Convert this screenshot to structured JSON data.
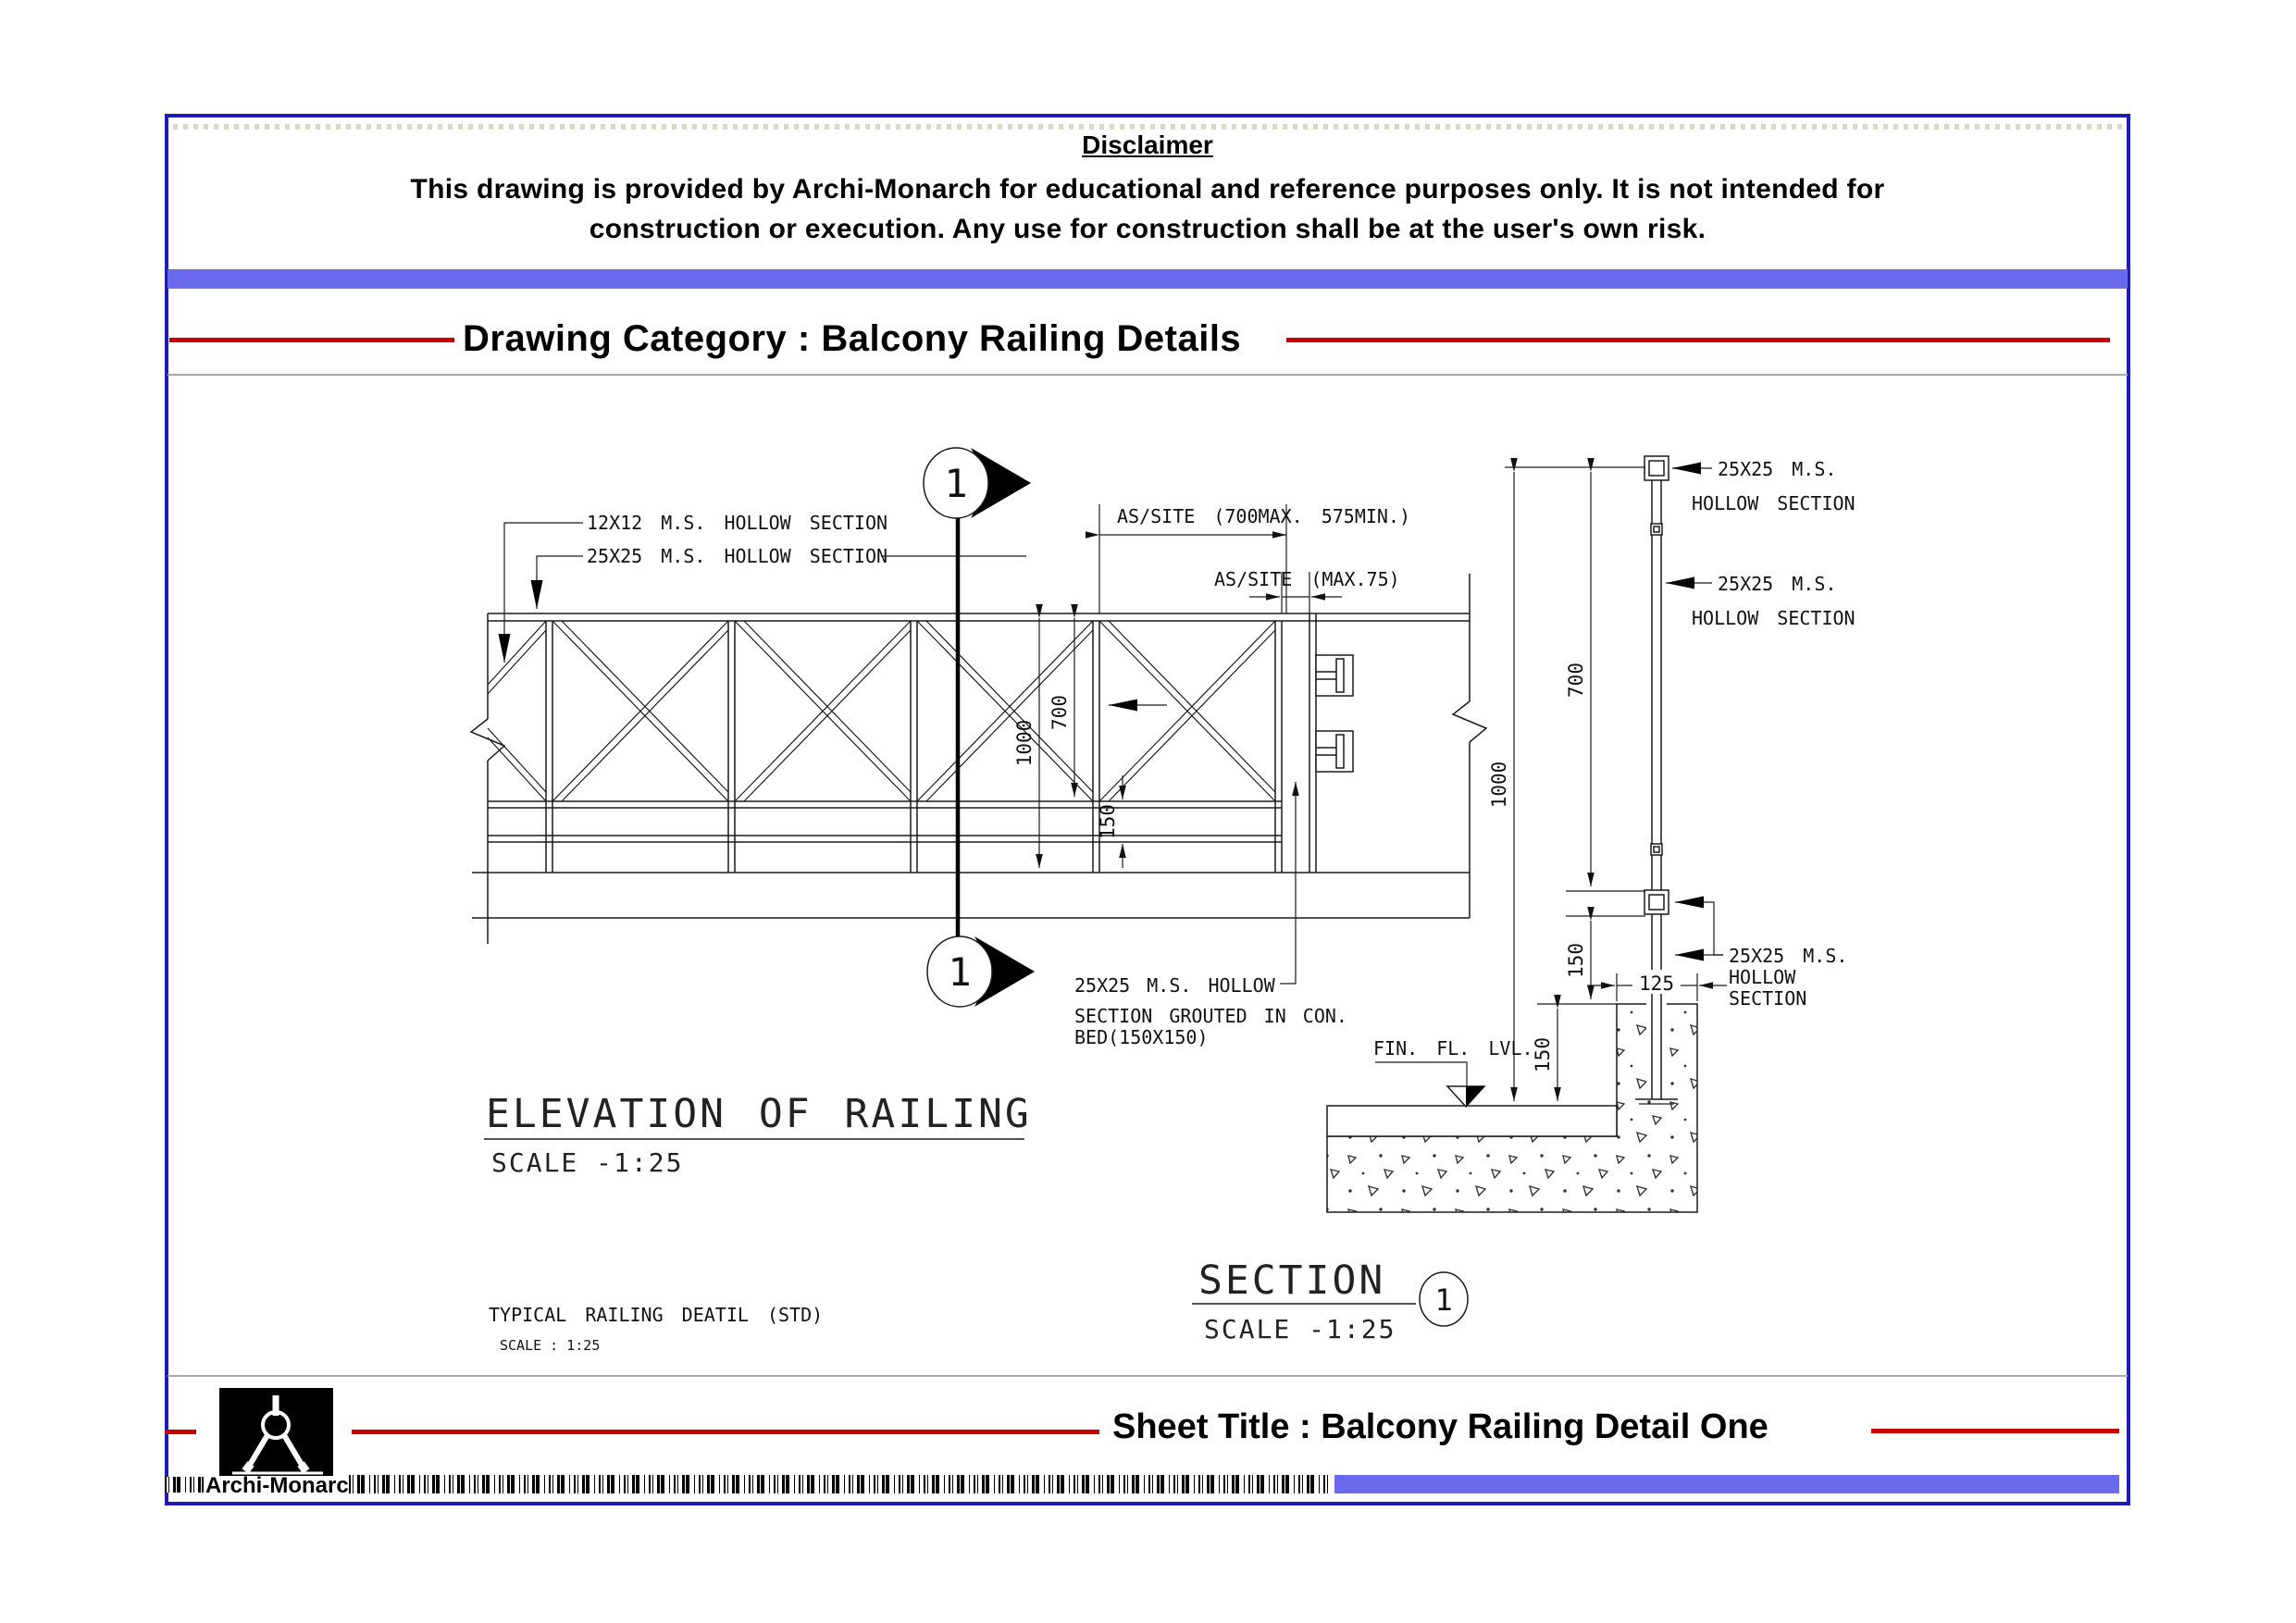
{
  "colors": {
    "border_navy": "#1d1ab5",
    "bar_blue": "#6a6aec",
    "accent_red": "#c80000",
    "line_black": "#1a1a1a"
  },
  "header": {
    "disclaimer_title": "Disclaimer",
    "disclaimer_line1": "This drawing is provided by Archi-Monarch for educational and reference purposes only. It is not intended for",
    "disclaimer_line2": "construction or execution. Any use for construction shall be at the user's own risk.",
    "category_label": "Drawing Category : Balcony Railing Details"
  },
  "footer": {
    "sheet_title": "Sheet Title : Balcony Railing Detail One",
    "brand": "Archi-Monarch"
  },
  "elevation": {
    "title": "ELEVATION OF RAILING",
    "scale": "SCALE -1:25",
    "label_12x12": "12X12 M.S. HOLLOW SECTION",
    "label_25x25": "25X25 M.S. HOLLOW SECTION",
    "dim_panel": "AS/SITE (700MAX. 575MIN.)",
    "dim_gap": "AS/SITE (MAX.75)",
    "dim_1000": "1000",
    "dim_700": "700",
    "dim_150": "150",
    "note_line1": "25X25 M.S. HOLLOW",
    "note_line2": "SECTION GROUTED IN CON.",
    "note_line3": "BED(150X150)",
    "marker_top": "1",
    "marker_bottom": "1",
    "footnote_title": "TYPICAL RAILING DEATIL (STD)",
    "footnote_scale": "SCALE : 1:25"
  },
  "section": {
    "title": "SECTION",
    "scale": "SCALE -1:25",
    "marker": "1",
    "fin_fl_lvl": "FIN. FL. LVL.",
    "label_top_1": "25X25 M.S.",
    "label_top_2": "HOLLOW SECTION",
    "label_mid_1": "25X25 M.S.",
    "label_mid_2": "HOLLOW SECTION",
    "label_base_1": "25X25 M.S.",
    "label_base_2": "HOLLOW",
    "label_base_3": "SECTION",
    "dim_1000": "1000",
    "dim_700": "700",
    "dim_150_upper": "150",
    "dim_150_lower": "150",
    "dim_125": "125"
  }
}
